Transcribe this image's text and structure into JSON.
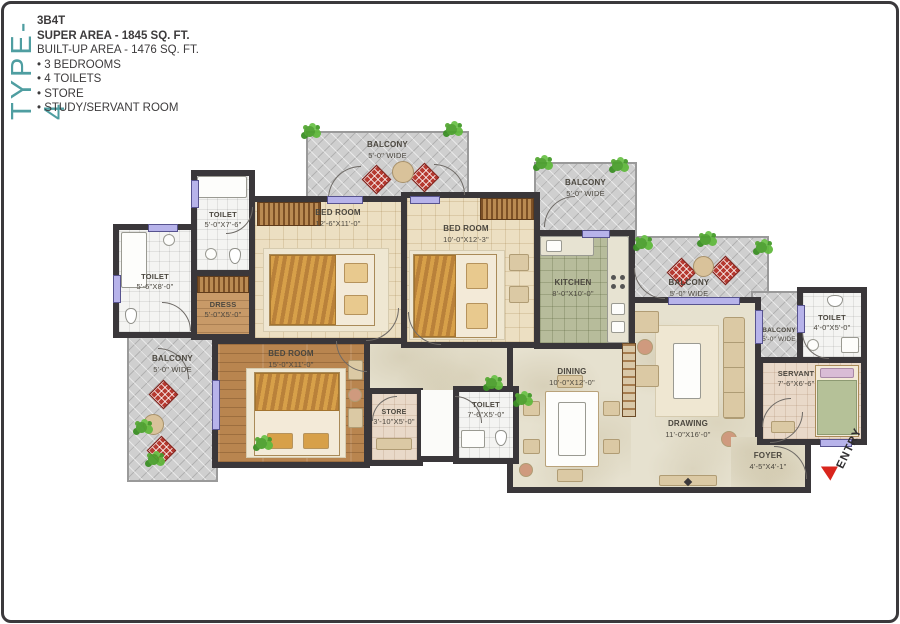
{
  "header": {
    "type_label": "TYPE-4",
    "code": "3B4T",
    "super_area": "SUPER AREA - 1845 SQ. FT.",
    "built_up_area": "BUILT-UP AREA - 1476 SQ. FT.",
    "features": [
      "• 3 BEDROOMS",
      "• 4 TOILETS",
      "• STORE",
      "• STUDY/SERVANT ROOM"
    ]
  },
  "plan": {
    "entry_label": "ENTRY",
    "rooms": {
      "balcony_top": {
        "name": "BALCONY",
        "dims": "5'-0\" WIDE"
      },
      "balcony_top_right": {
        "name": "BALCONY",
        "dims": "5'-0\" WIDE"
      },
      "balcony_right": {
        "name": "BALCONY",
        "dims": "5'-0\" WIDE"
      },
      "balcony_left": {
        "name": "BALCONY",
        "dims": "5'-0\" WIDE"
      },
      "balcony_small": {
        "name": "BALCONY",
        "dims": "5'-0\" WIDE"
      },
      "bedroom1": {
        "name": "BED ROOM",
        "dims": "12'-6\"X11'-0\""
      },
      "bedroom2": {
        "name": "BED ROOM",
        "dims": "10'-0\"X12'-3\""
      },
      "bedroom3": {
        "name": "BED ROOM",
        "dims": "15'-0\"X11'-0\""
      },
      "kitchen": {
        "name": "KITCHEN",
        "dims": "8'-0\"X10'-0\""
      },
      "toilet1": {
        "name": "TOILET",
        "dims": "5'-0\"X7'-6\""
      },
      "toilet2": {
        "name": "TOILET",
        "dims": "5'-6\"X8'-0\""
      },
      "toilet3": {
        "name": "TOILET",
        "dims": "7'-6\"X5'-0\""
      },
      "toilet4": {
        "name": "TOILET",
        "dims": "4'-0\"X5'-0\""
      },
      "dress": {
        "name": "DRESS",
        "dims": "5'-0\"X5'-0\""
      },
      "store": {
        "name": "STORE",
        "dims": "3'-10\"X5'-0\""
      },
      "dining": {
        "name": "DINING",
        "dims": "10'-0\"X12'-0\""
      },
      "drawing": {
        "name": "DRAWING",
        "dims": "11'-0\"X16'-0\""
      },
      "servant": {
        "name": "SERVANT",
        "dims": "7'-6\"X6'-6\""
      },
      "foyer": {
        "name": "FOYER",
        "dims": "4'-5\"X4'-1\""
      }
    }
  },
  "colors": {
    "accent_teal": "#4F9EA1",
    "wall_dark": "#3A373A",
    "entry_red": "#D9251D",
    "window_lavender": "#B7B3EA",
    "chair_red": "#B63A31",
    "cream": "#E6E1CF"
  }
}
